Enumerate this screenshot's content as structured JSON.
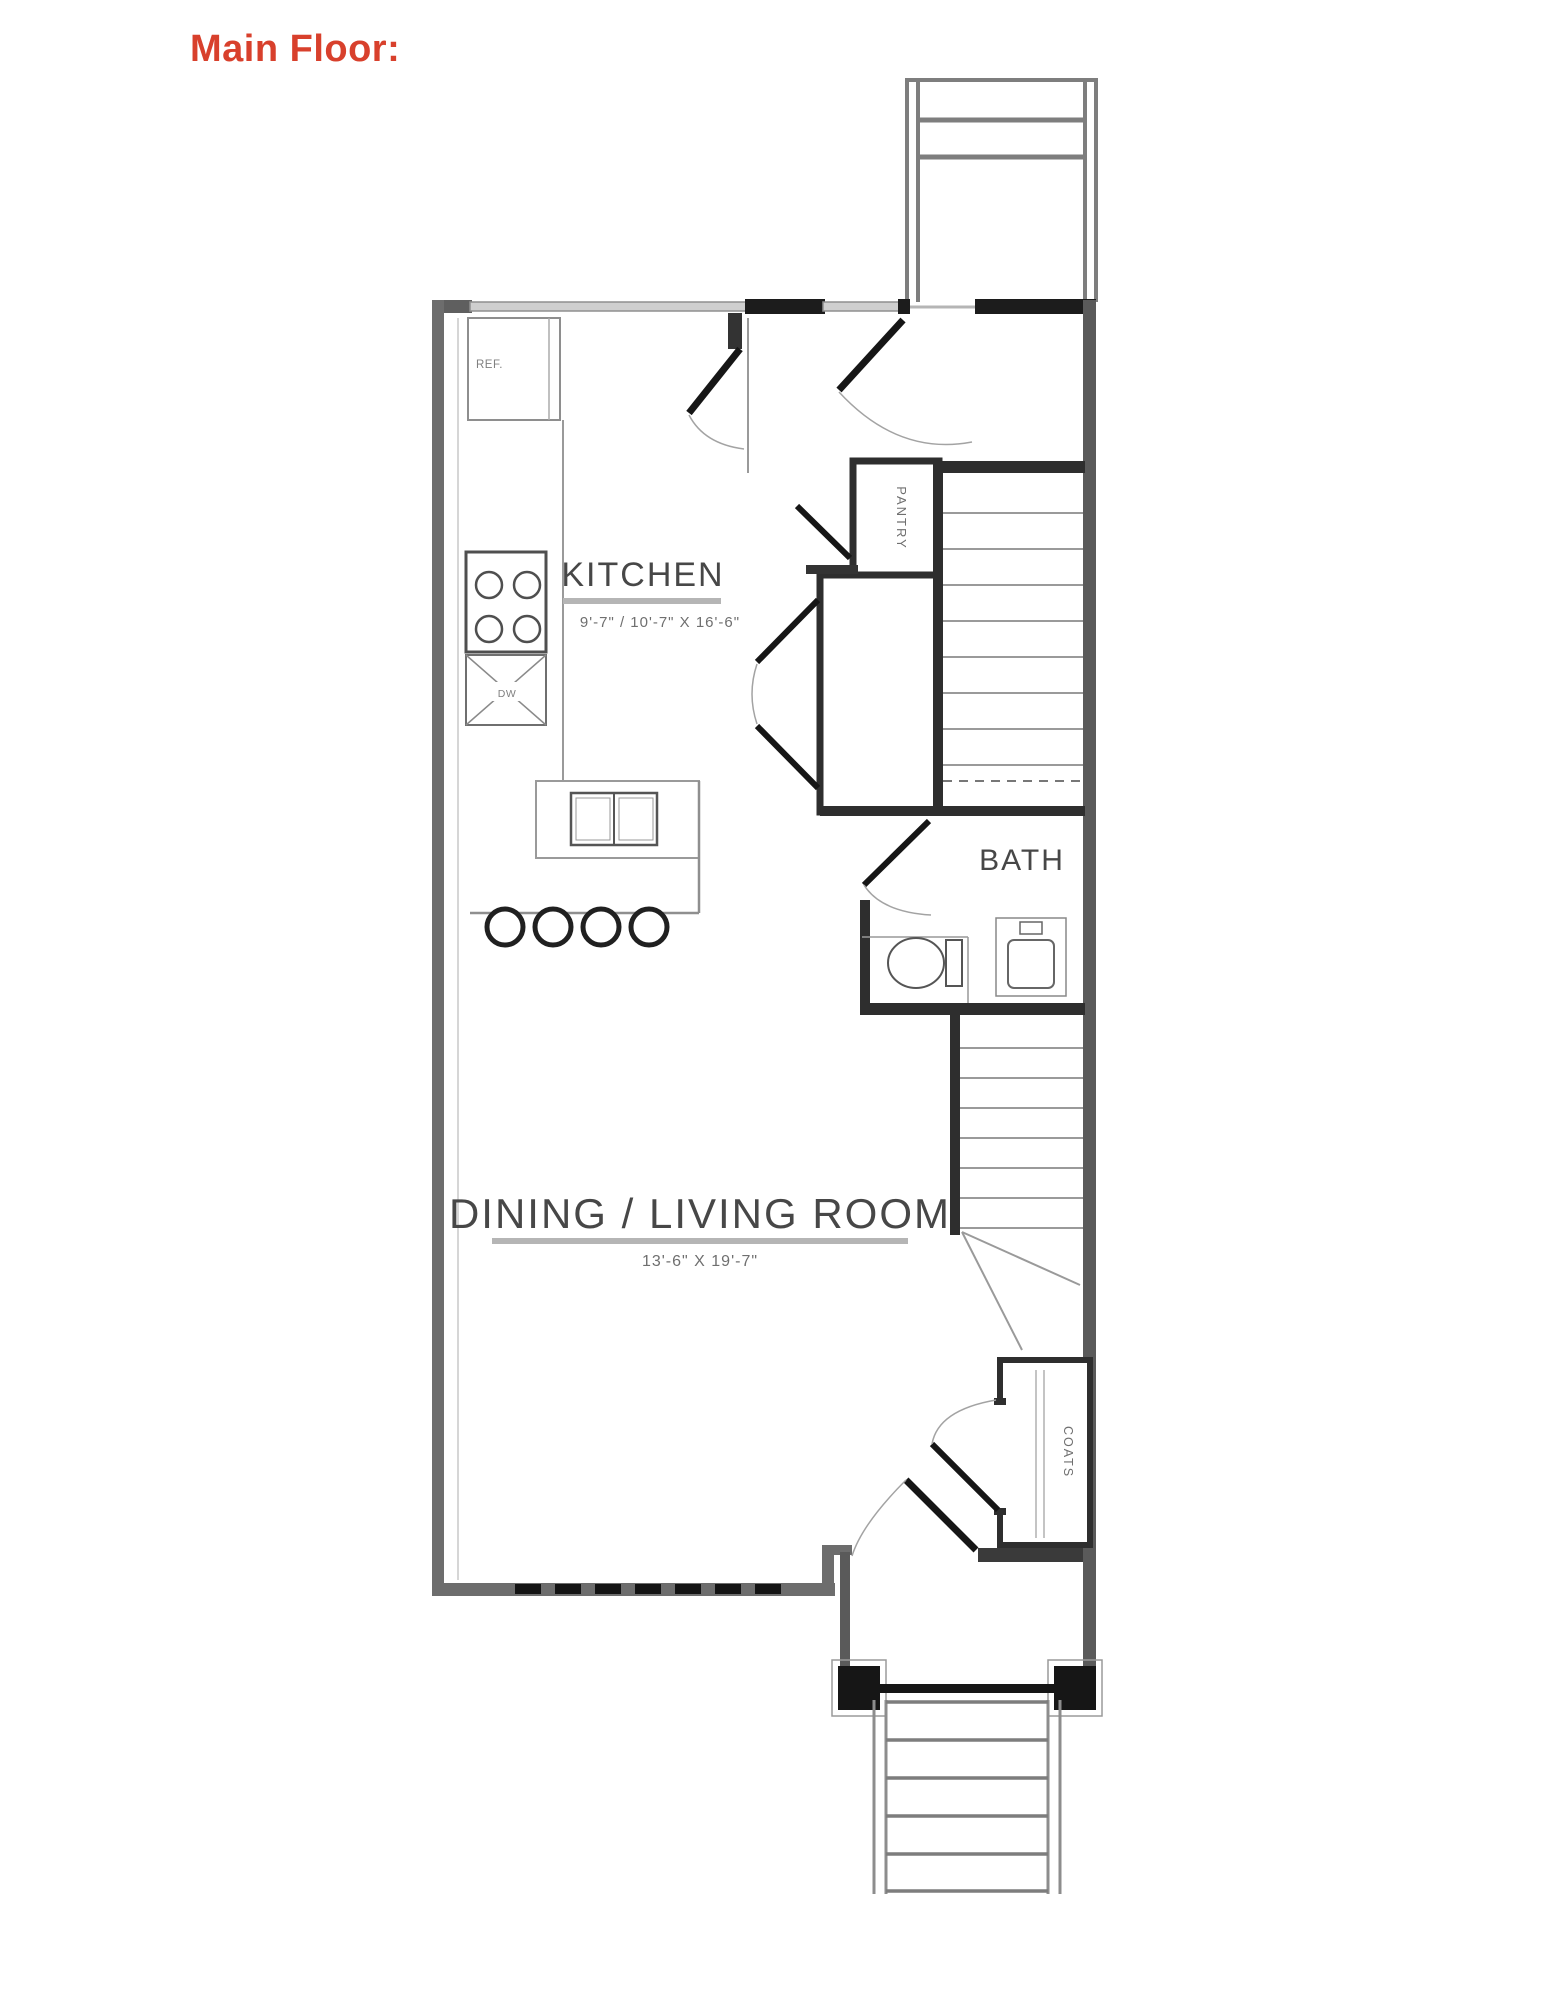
{
  "title": {
    "label": "Main Floor:"
  },
  "colors": {
    "title": "#d8402c",
    "room_text": "#474747",
    "dim_text": "#6f6f6f",
    "wall_dark": "#1c1c1c",
    "wall_gray": "#5f5f5f",
    "window_band": "#cfcfcf"
  },
  "rooms": {
    "kitchen": {
      "label": "KITCHEN",
      "dimensions": "9'-7\" / 10'-7\" X 16'-6\""
    },
    "dining_living": {
      "label": "DINING / LIVING ROOM",
      "dimensions": "13'-6\" X 19'-7\""
    },
    "bath": {
      "label": "BATH"
    },
    "pantry": {
      "label": "PANTRY"
    },
    "coats": {
      "label": "COATS"
    }
  },
  "fixtures": {
    "refrigerator": "REF.",
    "dishwasher": "DW"
  }
}
